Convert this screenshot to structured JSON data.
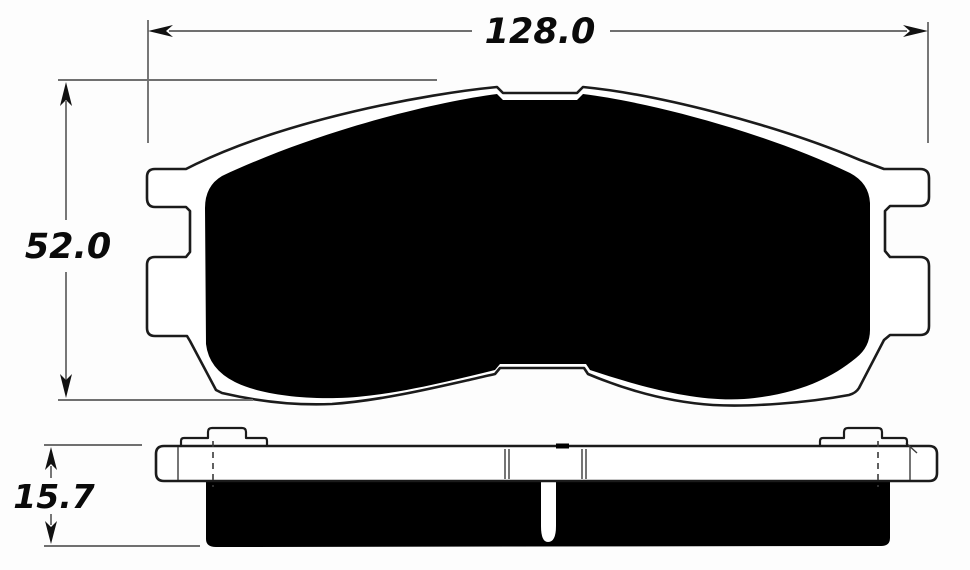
{
  "drawing": {
    "dimensions": {
      "width": {
        "value": "128.0"
      },
      "height": {
        "value": "52.0"
      },
      "thickness": {
        "value": "15.7"
      }
    },
    "colors": {
      "background": "#fdfdfd",
      "outline": "#1b1b1b",
      "plate_fill": "#ffffff",
      "friction_fill": "#000000",
      "dimension_line": "#707070",
      "dimension_arrow": "#111111",
      "dimension_text": "#0a0a0a"
    }
  }
}
